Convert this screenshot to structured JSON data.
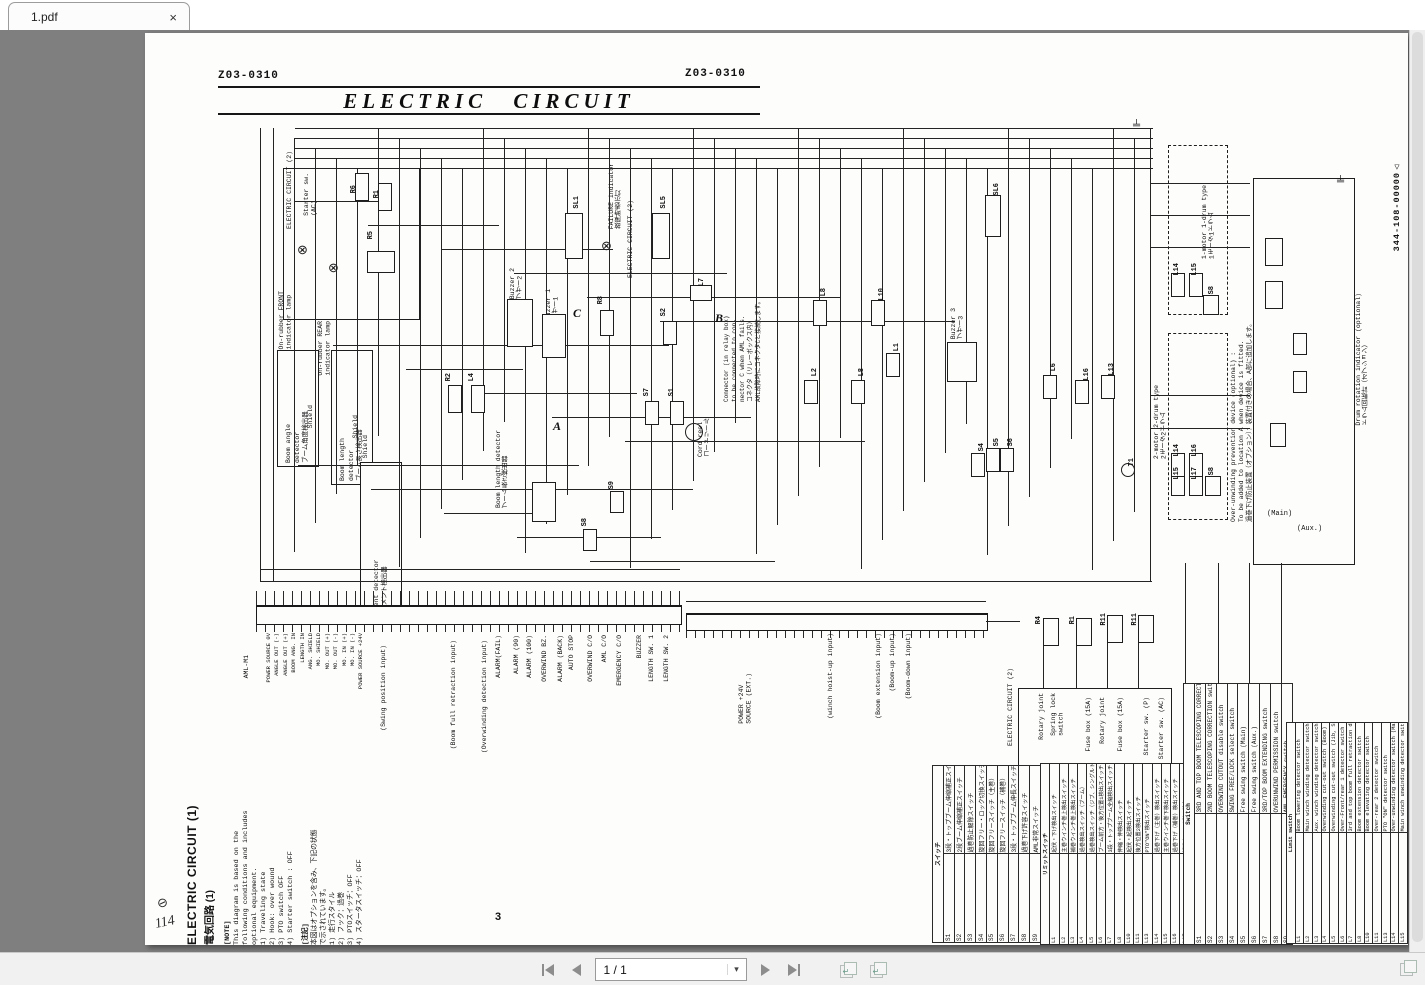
{
  "tab": {
    "title": "1.pdf"
  },
  "icons": {
    "close": "×",
    "caret": "▾",
    "lamp": "⊗",
    "ground": "╧",
    "transfer_arrow": "↵",
    "scribble": "⊘"
  },
  "toolbar": {
    "page_indicator": "1 / 1"
  },
  "page_header": {
    "doc_no_left": "Z03-0310",
    "doc_no_right": "Z03-0310",
    "title": "ELECTRIC  CIRCUIT",
    "page_number": "3",
    "handwritten": "114",
    "margin_no": "344-108-00000△"
  },
  "notes": {
    "heading_en": "ELECTRIC  CIRCUIT (1)",
    "heading_jp": "電気回路 (1)",
    "en_title": "[NOTE]",
    "en_lines": [
      "This diagram is based on the",
      "following conditions and includes",
      "optional equipment.",
      "1) Traveling state",
      "2) Hook: over wound",
      "3) PTO switch  OFF",
      "4) Starter switch : OFF"
    ],
    "jp_title": "[注記]",
    "jp_lines": [
      "本図はオプションを含み、下記の状態",
      "で示されています。",
      "1) 走行スタイル",
      "2) フック：過巻",
      "3) PTOスイッチ：OFF",
      "4) スタータスイッチ：OFF"
    ]
  },
  "labels": {
    "elec2_top": "ELECTRIC CIRCUIT (2)",
    "starter_ac_1": "Starter sw.",
    "starter_ac_2": "(AC)",
    "front_lamp_1": "On-rubber FRONT",
    "front_lamp_2": "indicator lamp",
    "rear_lamp_1": "On-rubber REAR",
    "rear_lamp_2": "indicator lamp",
    "boom_angle_en": "Boom angle",
    "boom_angle_en2": "detector",
    "boom_angle_jp": "ブーム角度検出器",
    "boom_len_en": "Boom length",
    "boom_len_en2": "detector",
    "boom_len_jp": "ブーム長さ検出器",
    "moment_en": "Moment detector",
    "moment_jp": "モーメント検出器",
    "shield": "Shield",
    "boom_len2_en": "Boom length detector",
    "boom_len2_jp": "ブーム長さ検出器",
    "failure_1": "FAILURE indicator",
    "failure_2": "故障時表示灯",
    "elec2_mid": "ELECTRIC CIRCUIT (2)",
    "buzzer1_en": "Buzzer 1",
    "buzzer1_jp": "ブザー1",
    "buzzer2_en": "Buzzer 2",
    "buzzer2_jp": "ブザー2",
    "buzzer3_en": "Buzzer 3",
    "buzzer3_jp": "ブザー3",
    "timer_en": "Timer",
    "timer_jp": "タイマ",
    "cord_en": "Cord reel",
    "cord_jp": "コードリール",
    "connector_note": [
      "Connector (in relay box)",
      "to be connected to con-",
      "nector C when AML fails.",
      "コネクタ（リレーボックス内）",
      "AML故障時にコネクタCと接続します。"
    ],
    "motor1_en": "1-motor 1-drum type",
    "motor1_jp": "1モータ1ドラム",
    "motor2_en": "2-motor 2-drum type",
    "motor2_jp": "2モータ2ドラム",
    "overunwind_note": [
      "Over-unwinding prevention device (optional) :",
      "To be added to location A when device is fitted.",
      "過巻下げ防止装置（オプション）：装置付きの場合、A部に追加します。"
    ],
    "drum_en": "Drum rotation indicator (optional)",
    "drum_jp": "ドラム回転計（オプション）",
    "main_tag": "(Main)",
    "aux_tag": "(Aux.)",
    "aml": "AML-M1",
    "power_ext_1": "POWER +24V",
    "power_ext_2": "SOURCE (EXT.)",
    "elec2_bottom": "ELECTRIC CIRCUIT (2)"
  },
  "schematic": {
    "aml_terminals": [
      "POWER SOURCE 0V",
      "ANGLE OUT (-)",
      "ANGLE OUT (+)",
      "BOOM ANG. IN",
      "LENGTH IN",
      "ANG. SHIELD",
      "MO. SHIELD",
      "MO. OUT (+)",
      "MO. OUT (-)",
      "MO. IN (+)",
      "MO. IN (-)",
      "POWER SOURCE +24V"
    ],
    "signals": [
      "(Swing position input)",
      "(Boom full retraction input)",
      "(Overwinding detection input)",
      "ALARM(FAIL)",
      "ALARM (90)",
      "ALARM (100)",
      "OVERWIND BZ.",
      "ALARM (BACK)",
      "AUTO STOP",
      "OVERWIND C/O",
      "AML C/O",
      "EMERGENCY C/O",
      "BUZZER",
      "LENGTH SW. 1",
      "LENGTH SW. 2",
      "(winch hoist-up input)",
      "(Boom extension input)",
      "(Boom-up input)",
      "(Boom-down input)"
    ],
    "elec2_items": [
      "Rotary joint",
      "Spring lock\nswitch",
      "Fuse box (15A)",
      "Rotary joint",
      "Fuse box (15A)",
      "Starter sw. (P)",
      "Starter sw. (AC)"
    ],
    "tags": [
      "R6",
      "R1",
      "R5",
      "R2",
      "L4",
      "SL1",
      "SL5",
      "SL6",
      "R8",
      "S2",
      "S7",
      "S1",
      "S9",
      "S8",
      "L7",
      "L8",
      "L10",
      "L1",
      "L2",
      "L8",
      "L6",
      "L16",
      "L13",
      "S4",
      "S5",
      "S6",
      "T1",
      "R4",
      "R1",
      "R11",
      "R11",
      "L14",
      "L15",
      "S8",
      "L14",
      "L16",
      "L15",
      "L17",
      "S8"
    ],
    "letters": [
      "A",
      "B",
      "C"
    ]
  },
  "tables": {
    "switch_en": {
      "header": "Switch",
      "rows": [
        [
          "S1",
          "3RD AND TOP BOOM TELESCOPING CORRECTION switch"
        ],
        [
          "S2",
          "2ND BOOM TELESCOPING CORRECTION switch"
        ],
        [
          "S3",
          "OVERWIND CUTOUT disable switch"
        ],
        [
          "S4",
          "SWING FREE/LOCK select switch"
        ],
        [
          "S5",
          "Free swing switch (Main)"
        ],
        [
          "S6",
          "Free swing switch (Aux.)"
        ],
        [
          "S7",
          "3RD/TOP BOOM EXTENDING switch"
        ],
        [
          "S8",
          "OVERUNWIND PERMISSION switch"
        ],
        [
          "S9",
          "AML EMERGENCY switch"
        ]
      ]
    },
    "limit_en": {
      "header": "Limit switch",
      "rows": [
        [
          "L1",
          "Boom lowering detector switch"
        ],
        [
          "L2",
          "Main winch winding detector switch"
        ],
        [
          "L3",
          "Aux. winch winding detector switch"
        ],
        [
          "L4",
          "Overwinding cut-out switch (Boom)"
        ],
        [
          "L5",
          "Overwinding cut-out switch (Jib, S/T)"
        ],
        [
          "L6",
          "Over-Front/rear 1 detector switch"
        ],
        [
          "L7",
          "3rd and top boom full retraction detector"
        ],
        [
          "L8",
          "Boom extension detector switch"
        ],
        [
          "L10",
          "Boom elevating detector switch"
        ],
        [
          "L11",
          "Over-rear 2 detector switch"
        ],
        [
          "L13",
          "PTO \"ON\" detector switch"
        ],
        [
          "L14",
          "Over-unwinding detector switch (Main)"
        ],
        [
          "L15",
          "Main winch unwinding detector switch"
        ],
        [
          "L16",
          "Over-unwinding detector switch (Aux.)"
        ],
        [
          "L17",
          "Aux. winch unwinding detector switch"
        ]
      ]
    },
    "switch_jp": {
      "header": "スイッチ",
      "rows": [
        [
          "S1",
          "3段・トップブーム伸縮補正スイッチ"
        ],
        [
          "S2",
          "2段ブーム伸縮補正スイッチ"
        ],
        [
          "S3",
          "過巻防止解除スイッチ"
        ],
        [
          "S4",
          "旋回フリー・ロック切換スイッチ"
        ],
        [
          "S5",
          "旋回フリースイッチ（主巻）"
        ],
        [
          "S6",
          "旋回フリースイッチ（補巻）"
        ],
        [
          "S7",
          "3段・トップブーム伸長スイッチ"
        ],
        [
          "S8",
          "過巻下げ許容スイッチ"
        ],
        [
          "S9",
          "AML非常スイッチ"
        ]
      ]
    },
    "limit_jp": {
      "header": "リミットスイッチ",
      "rows": [
        [
          "L1",
          "起伏・下げ検出スイッチ"
        ],
        [
          "L2",
          "主巻ウインチ巻上検出スイッチ"
        ],
        [
          "L3",
          "補巻ウインチ巻上検出スイッチ"
        ],
        [
          "L4",
          "過巻検出スイッチ（ブーム）"
        ],
        [
          "L5",
          "過巻検出スイッチ（ジブ、シングルトップ）"
        ],
        [
          "L6",
          "ブーム前方・後方位置1検出スイッチ"
        ],
        [
          "L7",
          "3段・トップブーム全縮検出スイッチ"
        ],
        [
          "L8",
          "伸縮・伸検出スイッチ"
        ],
        [
          "L10",
          "起伏・起検出スイッチ"
        ],
        [
          "L11",
          "後方位置2検出スイッチ"
        ],
        [
          "L13",
          "PTO\"ON\"検出スイッチ"
        ],
        [
          "L14",
          "過巻下げ（主巻）検出スイッチ"
        ],
        [
          "L15",
          "主巻ウインチ巻下検出スイッチ"
        ],
        [
          "L16",
          "過巻下げ（補巻）検出スイッチ"
        ],
        [
          "L17",
          "補巻ウインチ巻下検出スイッチ"
        ]
      ]
    }
  }
}
